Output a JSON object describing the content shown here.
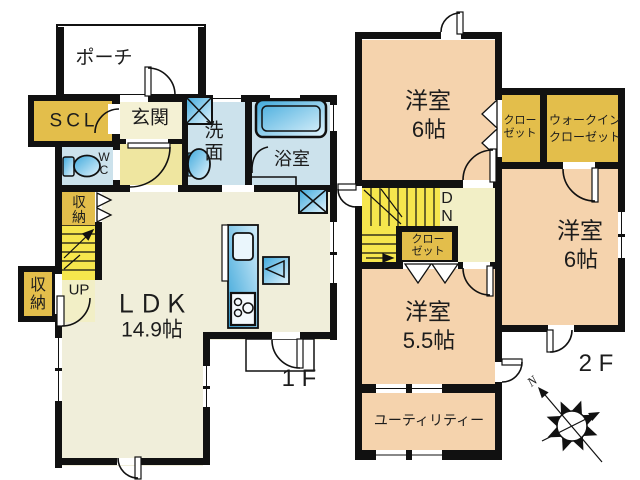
{
  "floor1": {
    "floor_label": "1 F",
    "porch": "ポーチ",
    "scl": "SCL",
    "genkan": "玄関",
    "wc": [
      "W",
      "C"
    ],
    "senmen": [
      "洗",
      "面"
    ],
    "bathroom": "浴室",
    "storage_stairs": [
      "収",
      "納"
    ],
    "storage_left": [
      "収",
      "納"
    ],
    "stairs_up": "UP",
    "ldk": [
      "ＬＤＫ",
      "14.9帖"
    ]
  },
  "floor2": {
    "floor_label": "2 F",
    "bedroom_top": [
      "洋室",
      "6帖"
    ],
    "closet_top": [
      "クロー",
      "ゼット"
    ],
    "walkin_closet": [
      "ウォークイン",
      "クローゼット"
    ],
    "bedroom_right": [
      "洋室",
      "6帖"
    ],
    "stairs_down": [
      "D",
      "N"
    ],
    "closet_stairs": [
      "クロー",
      "ゼット"
    ],
    "bedroom_55": [
      "洋室",
      "5.5帖"
    ],
    "utility": "ユーティリティー"
  },
  "compass": {
    "north": "N"
  },
  "colors": {
    "wall": "#111111",
    "gold": "#e3be4b",
    "stair_yellow": "#f6e64d",
    "pale_yellow": "#f2efc6",
    "hall_yellow": "#efe6a0",
    "blue_room": "#cce2ec",
    "cream": "#f0eeda",
    "peach": "#f5d3ad",
    "fixture_blue": "#3fa9dc"
  }
}
